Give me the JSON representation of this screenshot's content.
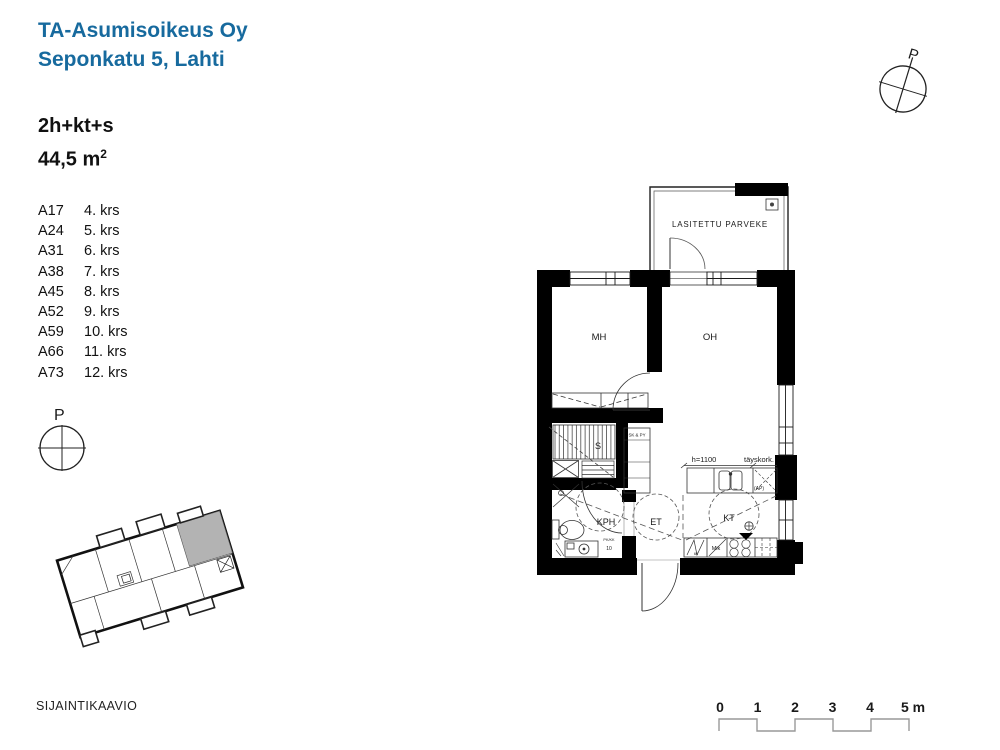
{
  "header": {
    "company": "TA-Asumisoikeus Oy",
    "address": "Seponkatu 5, Lahti",
    "accent_color": "#176a9e"
  },
  "apartment": {
    "type": "2h+kt+s",
    "area": "44,5 m",
    "area_sup": "2"
  },
  "units": [
    {
      "code": "A17",
      "floor": "4. krs"
    },
    {
      "code": "A24",
      "floor": "5. krs"
    },
    {
      "code": "A31",
      "floor": "6. krs"
    },
    {
      "code": "A38",
      "floor": "7. krs"
    },
    {
      "code": "A45",
      "floor": "8. krs"
    },
    {
      "code": "A52",
      "floor": "9. krs"
    },
    {
      "code": "A59",
      "floor": "10. krs"
    },
    {
      "code": "A66",
      "floor": "11. krs"
    },
    {
      "code": "A73",
      "floor": "12. krs"
    }
  ],
  "compass_label": "P",
  "floorplan": {
    "balcony": "LASITETTU PARVEKE",
    "room_mh": "MH",
    "room_oh": "OH",
    "room_kph": "KPH",
    "room_et": "ET",
    "room_kt": "KT",
    "room_sauna": "S",
    "closet": "SK & PY",
    "dim_height": "h=1100",
    "full_height": "täyskork.",
    "ap": "(AP)",
    "mik": "Mik",
    "dim60": "60",
    "door10": "10",
    "pk": "PK/KK"
  },
  "siteplan": {
    "caption": "SIJAINTIKAAVIO",
    "highlight_color": "#b3b3b3"
  },
  "scalebar": {
    "t0": "0",
    "t1": "1",
    "t2": "2",
    "t3": "3",
    "t4": "4",
    "t5": "5 m"
  }
}
